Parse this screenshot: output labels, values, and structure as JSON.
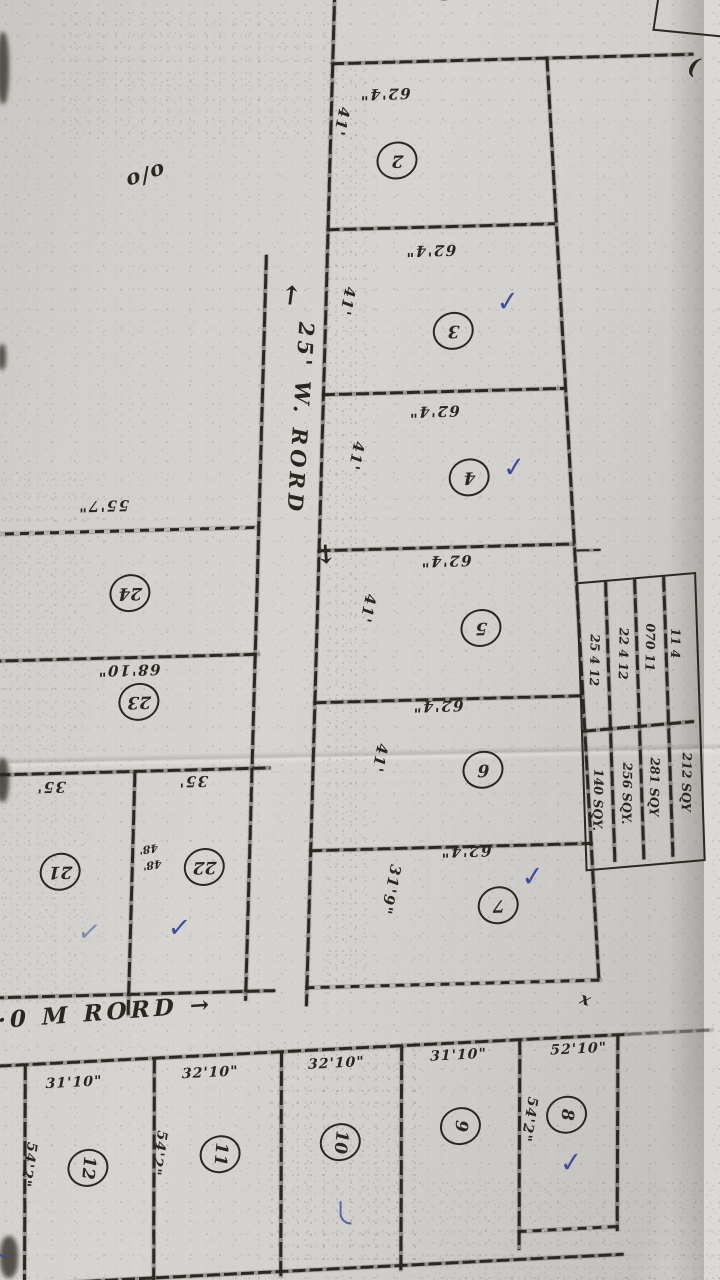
{
  "sheet": {
    "corner_mark": "o/o",
    "roads": {
      "main": {
        "arrow_up": "←",
        "name": "25' W. RORD",
        "arrow_down": "→"
      },
      "bottom": {
        "name": "6·0 M RORD",
        "arrow": "→"
      }
    },
    "right_column": {
      "plots": [
        {
          "num": "2",
          "width_label": "62'4\"",
          "depth_label": "41'"
        },
        {
          "num": "3",
          "width_label": "62'4\"",
          "depth_label": "41'"
        },
        {
          "num": "4",
          "width_label": "62'4\"",
          "depth_label": "41'"
        },
        {
          "num": "5",
          "width_label": "62'4\"",
          "depth_label": "41'"
        },
        {
          "num": "6",
          "width_label": "62'4\"",
          "depth_label": "41'"
        },
        {
          "num": "7",
          "width_label": "62'4\"",
          "depth_label": "31'9\""
        }
      ]
    },
    "left_column": {
      "plot24": {
        "num": "24",
        "width_label": "55'7\""
      },
      "plot23": {
        "num": "23",
        "width_label": "68'10\""
      },
      "plot22": {
        "num": "22",
        "width_label": "35'"
      },
      "plot21": {
        "num": "21",
        "width_label": "35'"
      },
      "side_note": "48'"
    },
    "bottom_row": {
      "plots": [
        {
          "num": "12",
          "width_label": "31'10\"",
          "depth_label": "54'2\""
        },
        {
          "num": "11",
          "width_label": "32'10\"",
          "depth_label": "54'2\""
        },
        {
          "num": "10",
          "width_label": "32'10\""
        },
        {
          "num": "9",
          "width_label": "31'10\"",
          "depth_label": "54'2\""
        },
        {
          "num": "8",
          "width_label": "52'10\""
        }
      ]
    },
    "area_table": {
      "rows": [
        {
          "size": "25 4 12",
          "area": "140 SQY."
        },
        {
          "size": "22 4 12",
          "area": "256 SQY."
        },
        {
          "size": "070 11",
          "area": "281 SQY"
        },
        {
          "size": "11 4",
          "area": "212 SQY"
        }
      ]
    },
    "marks": {
      "check": "✓",
      "x_corner": "x"
    }
  }
}
